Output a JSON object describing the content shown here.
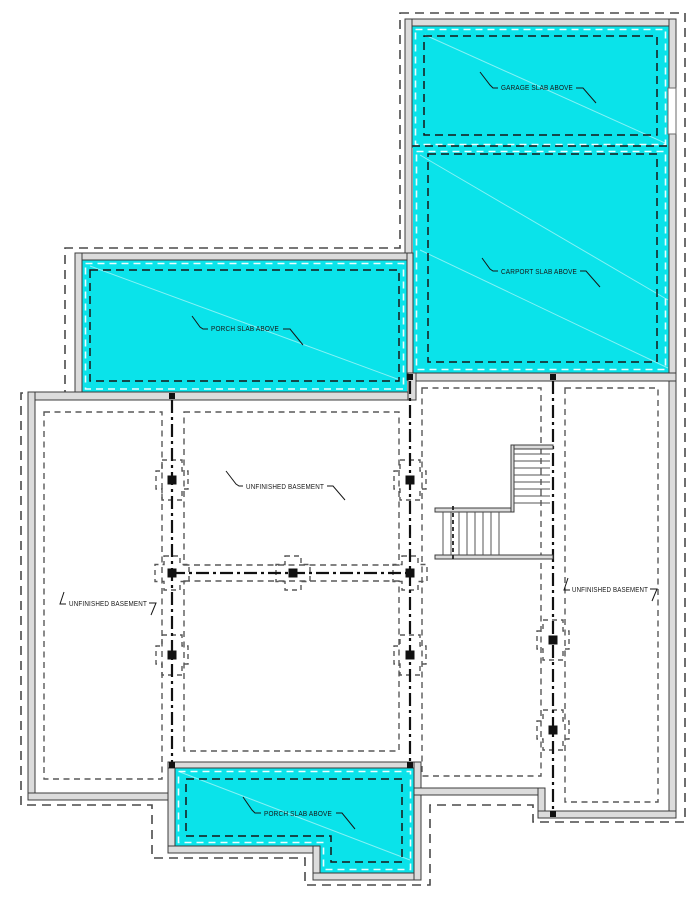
{
  "drawing": {
    "type": "foundation-basement-floor-plan"
  },
  "colors": {
    "slab_cyan": "#0ae3ea",
    "wall_fill": "#dcdcdc",
    "wall_stroke": "#3c3c3c",
    "white_dash": "#ffffff",
    "ink": "#161616"
  },
  "labels": {
    "garage": {
      "text": "GARAGE SLAB ABOVE"
    },
    "carport": {
      "text": "CARPORT SLAB ABOVE"
    },
    "porch_left": {
      "text": "PORCH SLAB ABOVE"
    },
    "porch_bottom": {
      "text": "PORCH SLAB ABOVE"
    },
    "basement_center": {
      "text": "UNFINISHED BASEMENT"
    },
    "basement_left": {
      "text": "UNFINISHED BASEMENT"
    },
    "basement_right": {
      "text": "UNFINISHED BASEMENT"
    }
  }
}
